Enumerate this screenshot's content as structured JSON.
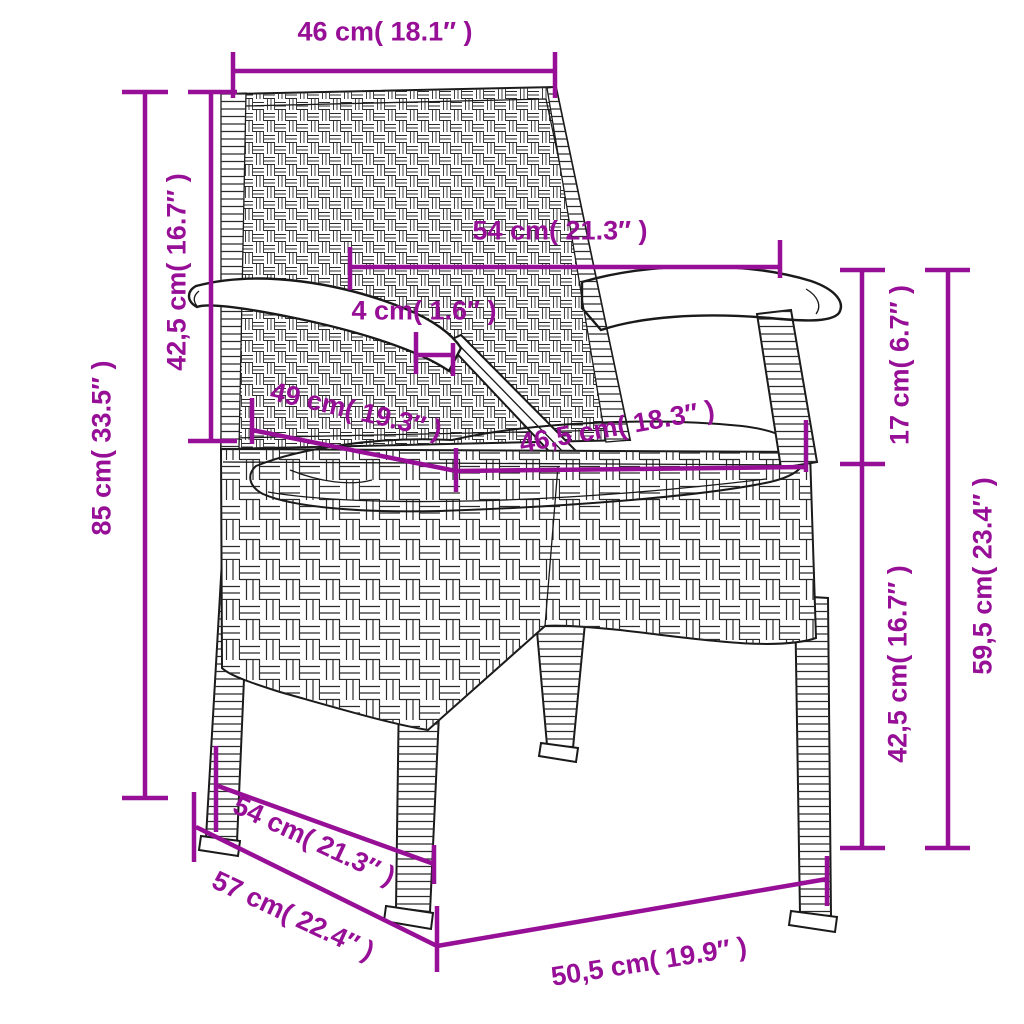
{
  "diagram": {
    "figure": "rattan-armchair-line-art",
    "accent_color": "#960f96",
    "art_color": "#1a1a1a",
    "weave_color": "#2b2b2b",
    "cushion_fill": "#fcfcfa",
    "labels": [
      {
        "id": "back-width",
        "text": "46 cm( 18.1″ )"
      },
      {
        "id": "backrest-height",
        "text": "42,5 cm( 16.7″ )"
      },
      {
        "id": "total-height",
        "text": "85 cm( 33.5″ )"
      },
      {
        "id": "armrest-span",
        "text": "54 cm( 21.3″ )"
      },
      {
        "id": "armrest-thickness",
        "text": "4 cm( 1.6″ )"
      },
      {
        "id": "seat-depth",
        "text": "49 cm( 19.3″ )"
      },
      {
        "id": "seat-width",
        "text": "46,5 cm( 18.3″ )"
      },
      {
        "id": "arm-to-seat",
        "text": "17 cm( 6.7″ )"
      },
      {
        "id": "seat-height",
        "text": "42,5 cm( 16.7″ )"
      },
      {
        "id": "armrest-height",
        "text": "59,5 cm( 23.4″ )"
      },
      {
        "id": "base-depth",
        "text": "54 cm( 21.3″ )"
      },
      {
        "id": "total-depth",
        "text": "57 cm( 22.4″ )"
      },
      {
        "id": "front-width",
        "text": "50,5 cm( 19.9″ )"
      }
    ]
  }
}
